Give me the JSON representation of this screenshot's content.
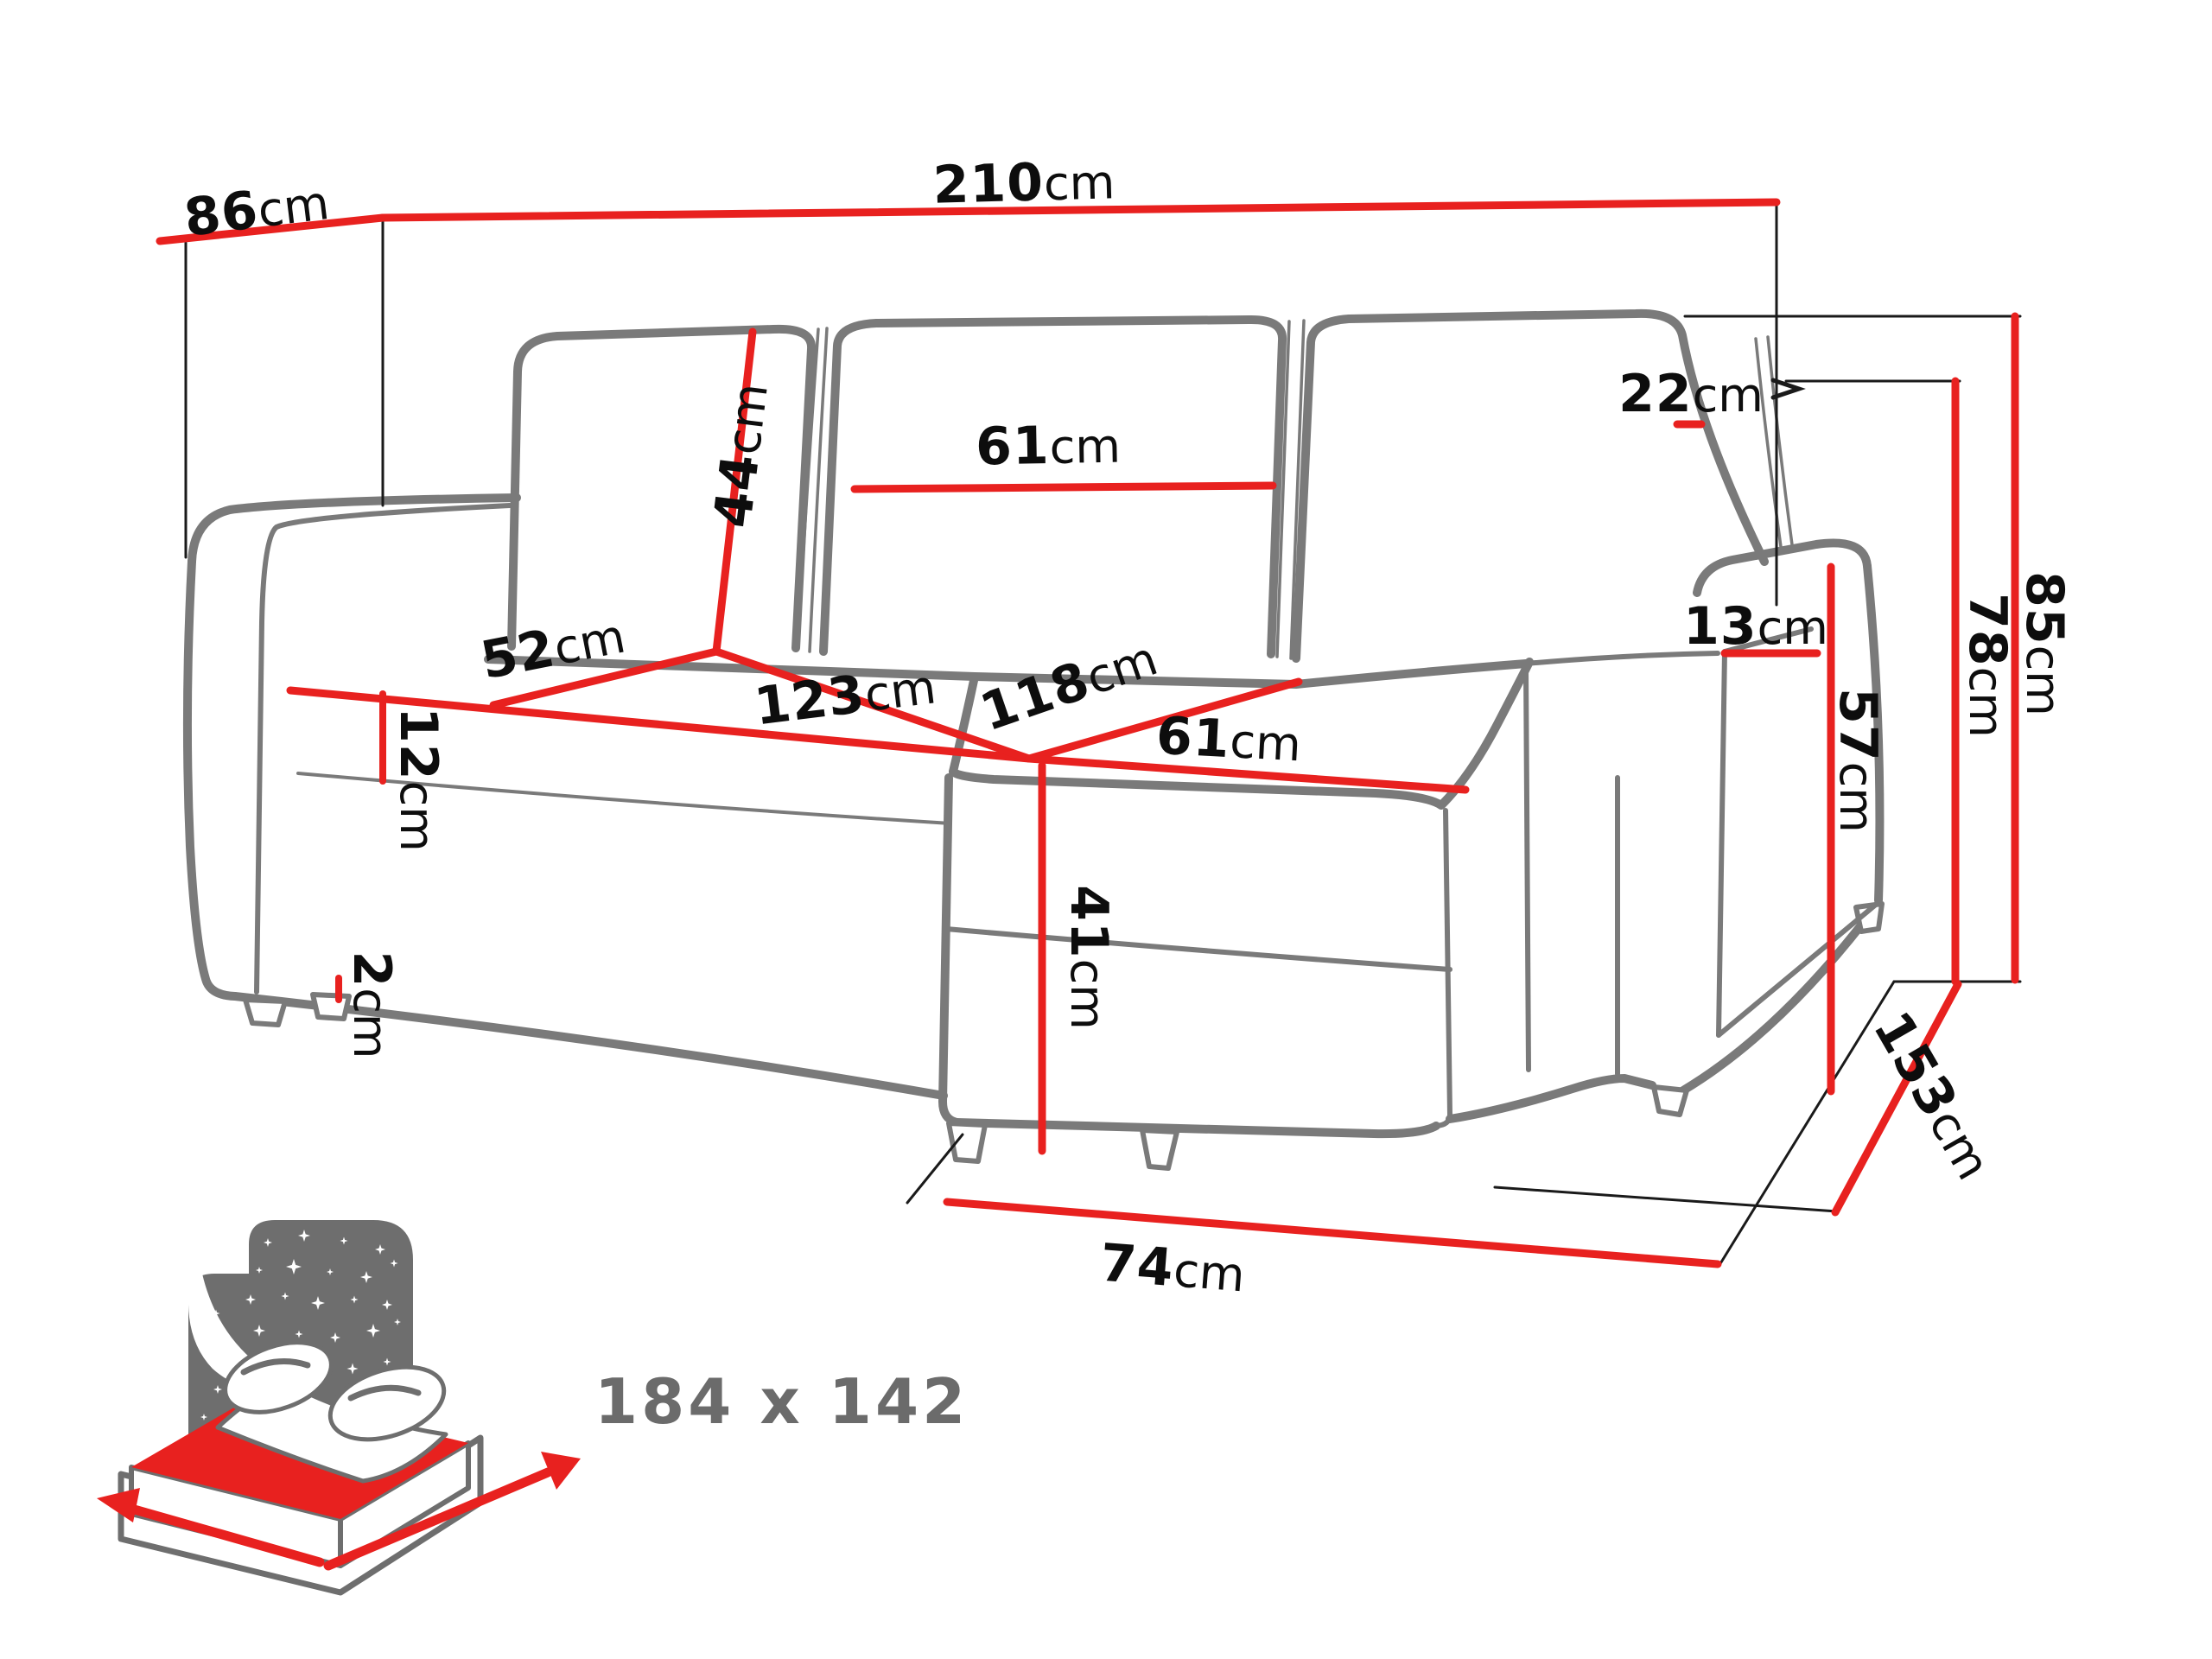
{
  "diagram": {
    "type": "furniture-dimension-diagram",
    "subject": "corner sofa bed with chaise",
    "colors": {
      "dimension_line": "#e8211f",
      "sofa_outline": "#7a7a7a",
      "label_text": "#0d0d0d",
      "bed_icon_gray": "#6e6e6e",
      "bed_icon_red": "#e8211f",
      "bed_size_text": "#6b6b6b"
    }
  },
  "dimensions": {
    "d86": {
      "value": "86",
      "unit": "cm"
    },
    "d210": {
      "value": "210",
      "unit": "cm"
    },
    "d22": {
      "value": "22",
      "unit": "cm"
    },
    "d44": {
      "value": "44",
      "unit": "cm"
    },
    "d61_back": {
      "value": "61",
      "unit": "cm"
    },
    "d52": {
      "value": "52",
      "unit": "cm"
    },
    "d123": {
      "value": "123",
      "unit": "cm"
    },
    "d118": {
      "value": "118",
      "unit": "cm"
    },
    "d61_seat": {
      "value": "61",
      "unit": "cm"
    },
    "d12": {
      "value": "12",
      "unit": "cm"
    },
    "d2": {
      "value": "2",
      "unit": "cm"
    },
    "d41": {
      "value": "41",
      "unit": "cm"
    },
    "d74": {
      "value": "74",
      "unit": "cm"
    },
    "d13": {
      "value": "13",
      "unit": "cm"
    },
    "d57": {
      "value": "57",
      "unit": "cm"
    },
    "d78": {
      "value": "78",
      "unit": "cm"
    },
    "d85": {
      "value": "85",
      "unit": "cm"
    },
    "d153": {
      "value": "153",
      "unit": "cm"
    }
  },
  "bed": {
    "size_label": "184 x 142"
  }
}
